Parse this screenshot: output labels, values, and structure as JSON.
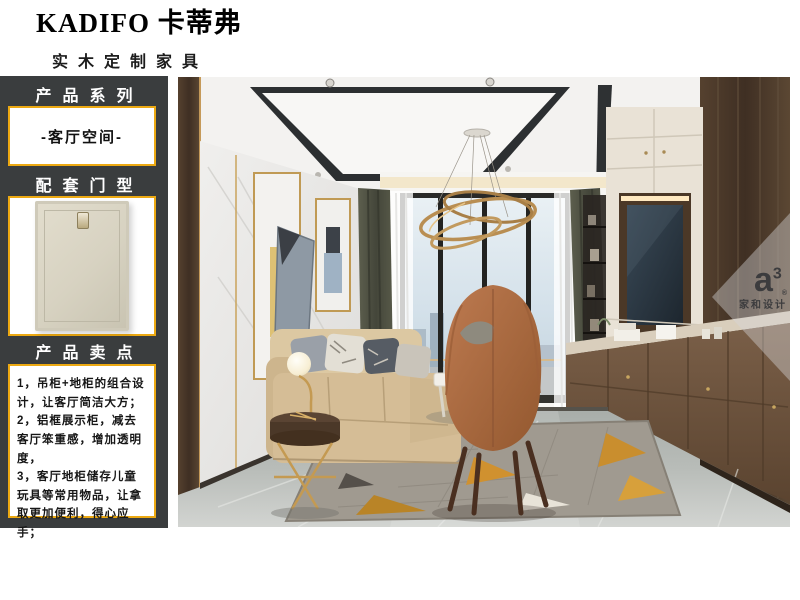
{
  "brand": {
    "logo": "KADIFO 卡蒂弗",
    "tagline": "实木定制家具"
  },
  "sidebar": {
    "sections": [
      {
        "title": "产品系列",
        "content": "-客厅空间-"
      },
      {
        "title": "配套门型",
        "content": "door-panel-image"
      },
      {
        "title": "产品卖点",
        "content": "1，吊柜+地柜的组合设计，让客厅简洁大方；\n2，铝框展示柜，减去客厅笨重感，增加透明度，\n3，客厅地柜储存儿童玩具等常用物品，让拿取更加便利，得心应手；"
      }
    ]
  },
  "watermark": {
    "letter": "a",
    "exponent": "3",
    "reg": "®",
    "name": "家和设计"
  },
  "colors": {
    "sidebar_bg": "#3a3d3e",
    "accent_gold": "#eca912",
    "page_bg": "#ffffff",
    "photo_wood": "#4a392c",
    "photo_sofa": "#d5bd96",
    "photo_chair": "#b06f45",
    "photo_rug_gold": "#d0912f"
  }
}
